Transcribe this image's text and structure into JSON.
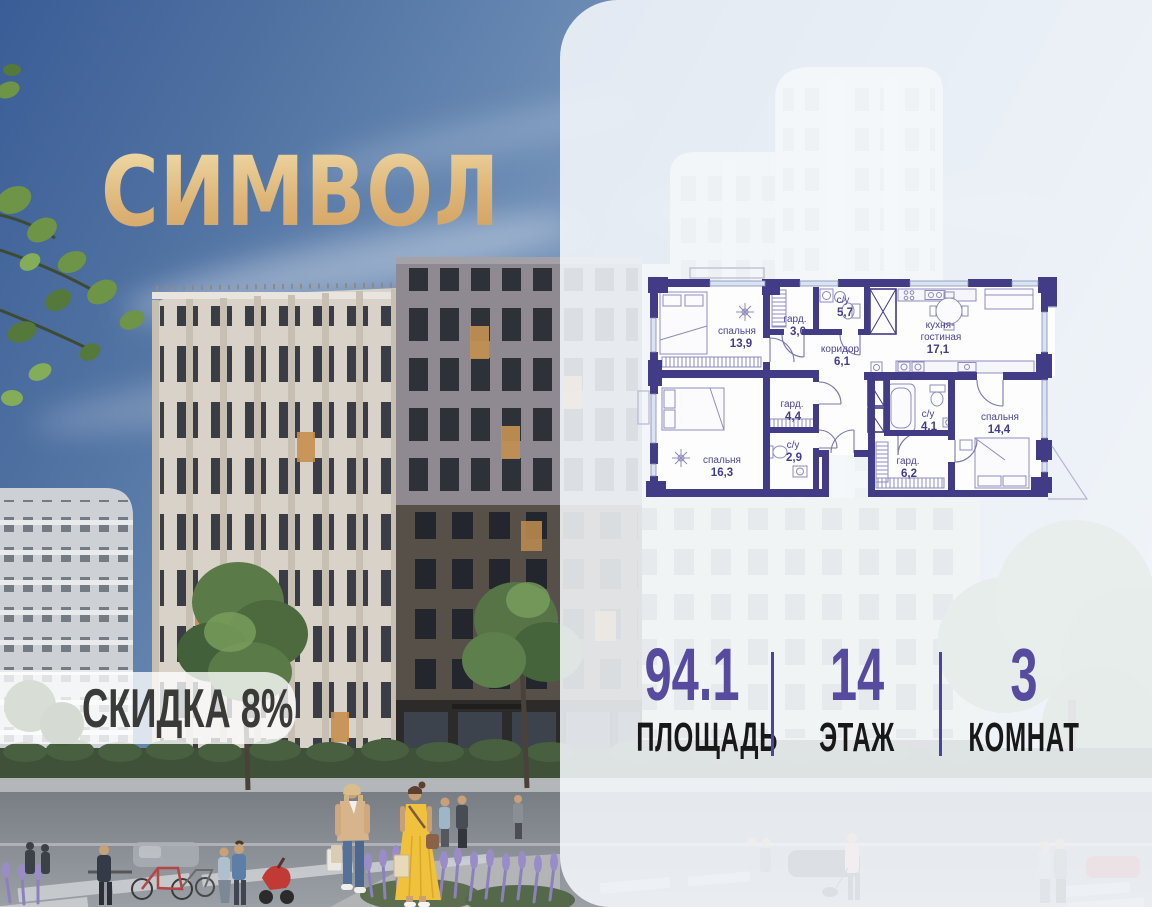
{
  "logo": {
    "text": "СИМВОЛ"
  },
  "discount_badge": {
    "text": "СКИДКА 8%"
  },
  "floor_plan": {
    "rooms": [
      {
        "name": "спальня",
        "area": "13,9",
        "nx": 737,
        "ny": 334,
        "ax": 741,
        "ay": 347
      },
      {
        "name": "гард.",
        "area": "3,0",
        "nx": 795,
        "ny": 322,
        "ax": 798,
        "ay": 335
      },
      {
        "name": "с/у",
        "area": "5,7",
        "nx": 843,
        "ny": 303,
        "ax": 845,
        "ay": 316
      },
      {
        "name": "коридор",
        "area": "6,1",
        "nx": 840,
        "ny": 352,
        "ax": 842,
        "ay": 365
      },
      {
        "name": "кухня-",
        "name2": "гостиная",
        "area": "17,1",
        "nx": 940,
        "ny": 328,
        "ny2": 340,
        "ax": 938,
        "ay": 353
      },
      {
        "name": "гард.",
        "area": "4,4",
        "nx": 792,
        "ny": 407,
        "ax": 793,
        "ay": 420
      },
      {
        "name": "с/у",
        "area": "2,9",
        "nx": 793,
        "ny": 448,
        "ax": 794,
        "ay": 461
      },
      {
        "name": "спальня",
        "area": "16,3",
        "nx": 722,
        "ny": 463,
        "ax": 722,
        "ay": 476
      },
      {
        "name": "с/у",
        "area": "4,1",
        "nx": 928,
        "ny": 417,
        "ax": 929,
        "ay": 430
      },
      {
        "name": "гард.",
        "area": "6,2",
        "nx": 908,
        "ny": 464,
        "ax": 909,
        "ay": 477
      },
      {
        "name": "спальня",
        "area": "14,4",
        "nx": 1000,
        "ny": 420,
        "ax": 999,
        "ay": 433
      }
    ]
  },
  "stats": {
    "area": {
      "value": "94.1",
      "label": "ПЛОЩАДЬ"
    },
    "floor": {
      "value": "14",
      "label": "ЭТАЖ"
    },
    "rooms": {
      "value": "3",
      "label": "КОМНАТ"
    }
  },
  "colors": {
    "accent": "#564b9f",
    "plan_wall": "#423b85",
    "logo_gold": "#dcb377",
    "divider": "#4c42a0"
  }
}
